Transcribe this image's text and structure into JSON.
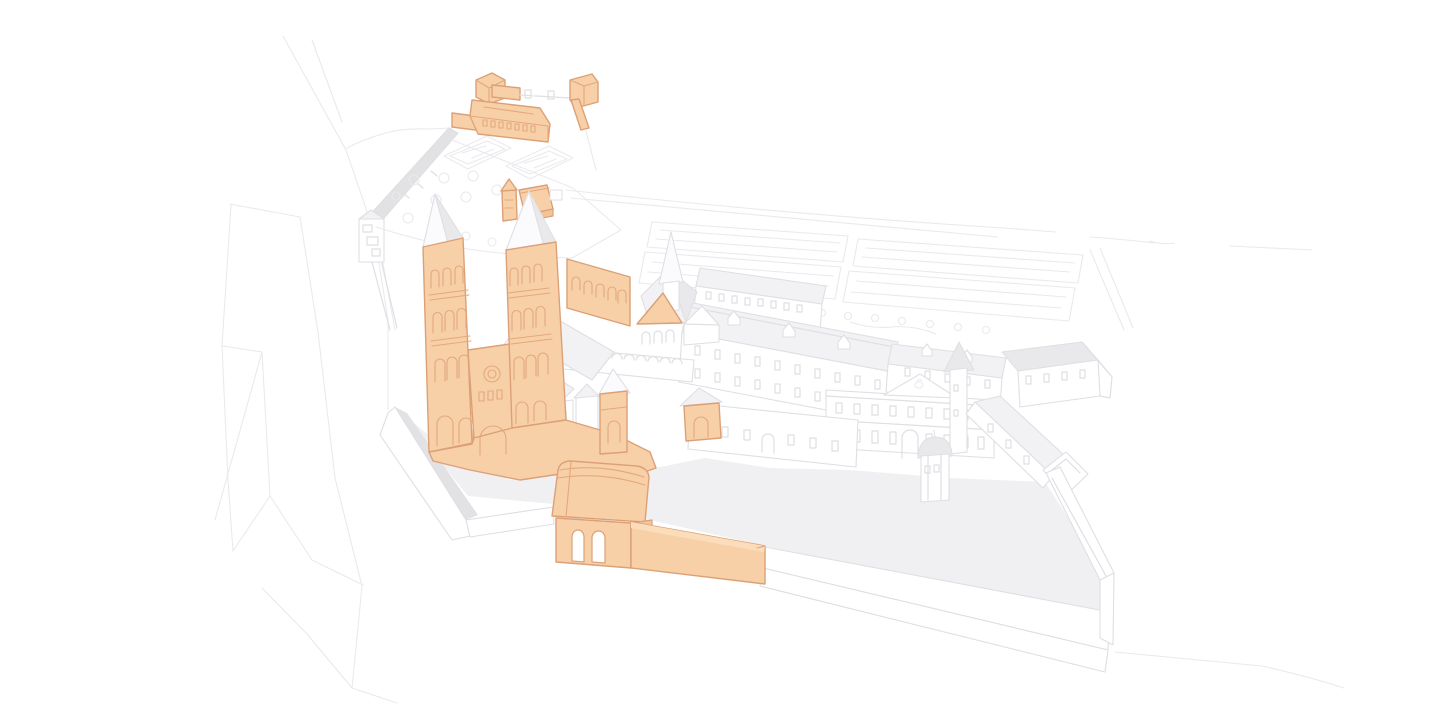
{
  "illustration": {
    "label": "abbey-complex-isometric-illustration",
    "style": "outline-sketch-with-highlighted-buildings",
    "colors": {
      "hl": "#F8D0A8",
      "hls": "#DCA077",
      "hld": "#E3A87C",
      "hl2": "#F3C497",
      "hl3": "#FBDDBC",
      "ln": "#DFDFE4",
      "ln2": "#EAEAEE",
      "roof": "#F2F2F4",
      "shade": "#E9E9EC",
      "spire": "#FBFBFD",
      "ground": "#F0F0F2",
      "band": "#E2E2E5",
      "white": "#FFFFFF"
    },
    "highlighted_elements": [
      "upper-courtyard-buildings",
      "abbey-church",
      "northeast-church-towers",
      "transept-gable",
      "southeast-chapel",
      "south-orange-house",
      "gatehouse",
      "gatehouse-wall"
    ],
    "muted_elements": [
      "cliff-outlines",
      "terrace-wall-and-tower",
      "terrace-garden-parterres",
      "terrace-trees",
      "kitchen-garden-plots",
      "monastery-north-wing",
      "monastery-long-wing",
      "monastery-east-wing",
      "court-building-with-pediment",
      "stair-turret",
      "southeast-wing",
      "courtyard-dome-tower",
      "cloister-arcade",
      "small-white-houses",
      "courtyard-ground",
      "perimeter-wall",
      "horizon-line"
    ]
  }
}
